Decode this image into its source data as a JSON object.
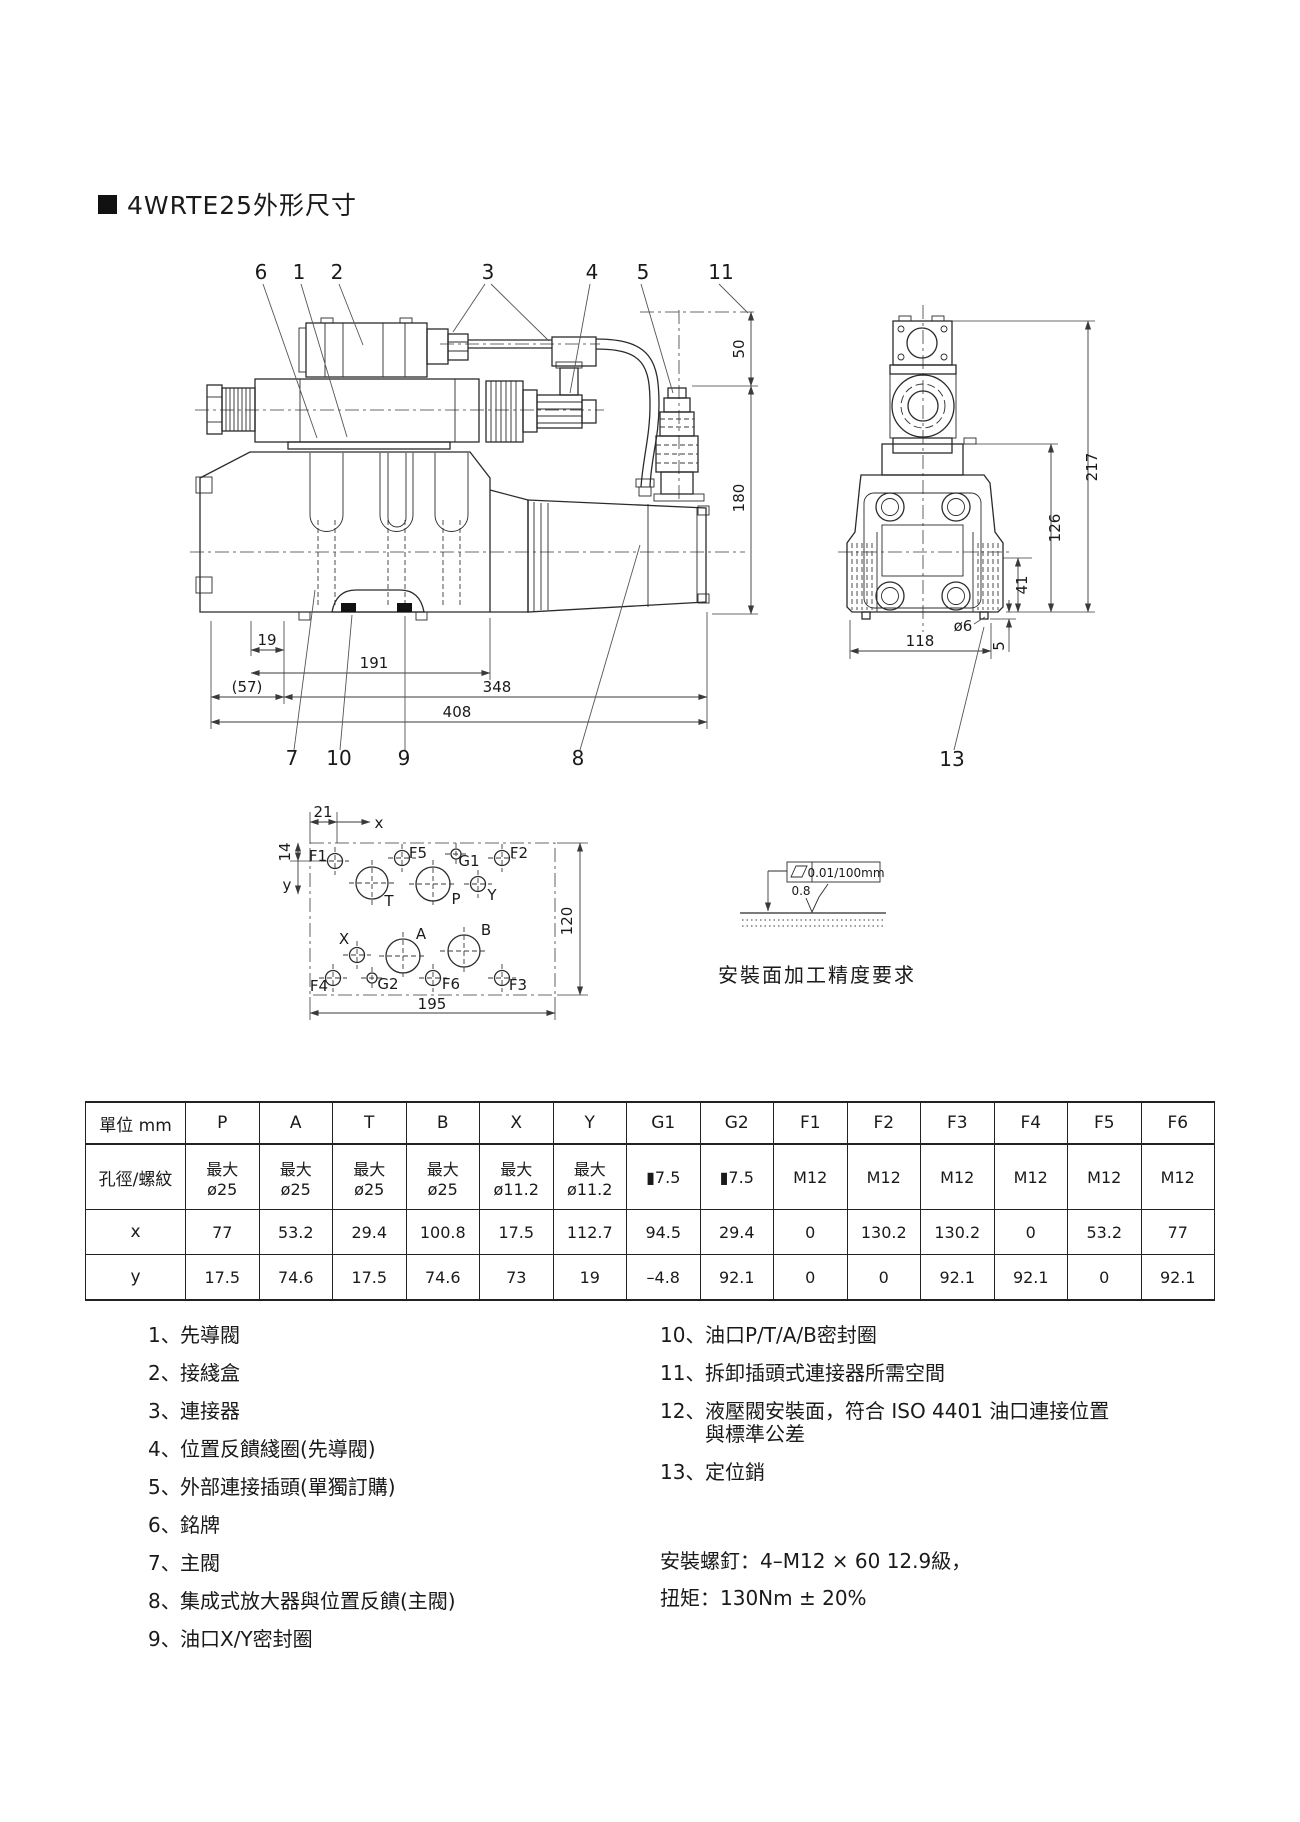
{
  "page": {
    "title": "4WRTE25外形尺寸"
  },
  "drawing": {
    "callouts": [
      "6",
      "1",
      "2",
      "3",
      "4",
      "5",
      "11",
      "7",
      "10",
      "9",
      "8",
      "13"
    ],
    "dims": {
      "d19": "19",
      "d191": "191",
      "d57": "(57)",
      "d348": "348",
      "d408": "408",
      "d50": "50",
      "d180": "180",
      "d217": "217",
      "d126": "126",
      "d41": "41",
      "d5": "5",
      "d118": "118",
      "dia6": "ø6"
    },
    "face": {
      "ports": [
        "F1",
        "F5",
        "G1",
        "F2",
        "T",
        "P",
        "Y",
        "X",
        "A",
        "B",
        "F4",
        "G2",
        "F6",
        "F3"
      ],
      "dims": {
        "d21": "21",
        "d14": "14",
        "d195": "195",
        "d120": "120"
      },
      "axis_x": "x",
      "axis_y": "y"
    },
    "finish": {
      "flatness": "0.01/100mm",
      "roughness": "0.8",
      "caption": "安裝面加工精度要求"
    }
  },
  "table": {
    "unit_header": "單位 mm",
    "spec_label": "孔徑/螺紋",
    "row_x_label": "x",
    "row_y_label": "y",
    "columns": [
      "P",
      "A",
      "T",
      "B",
      "X",
      "Y",
      "G1",
      "G2",
      "F1",
      "F2",
      "F3",
      "F4",
      "F5",
      "F6"
    ],
    "spec": [
      "最大\nø25",
      "最大\nø25",
      "最大\nø25",
      "最大\nø25",
      "最大\nø11.2",
      "最大\nø11.2",
      "▮7.5",
      "▮7.5",
      "M12",
      "M12",
      "M12",
      "M12",
      "M12",
      "M12"
    ],
    "x": [
      "77",
      "53.2",
      "29.4",
      "100.8",
      "17.5",
      "112.7",
      "94.5",
      "29.4",
      "0",
      "130.2",
      "130.2",
      "0",
      "53.2",
      "77"
    ],
    "y": [
      "17.5",
      "74.6",
      "17.5",
      "74.6",
      "73",
      "19",
      "–4.8",
      "92.1",
      "0",
      "0",
      "92.1",
      "92.1",
      "0",
      "92.1"
    ]
  },
  "legend": {
    "left": [
      {
        "num": "1、",
        "text": "先導閥"
      },
      {
        "num": "2、",
        "text": "接綫盒"
      },
      {
        "num": "3、",
        "text": "連接器"
      },
      {
        "num": "4、",
        "text": "位置反饋綫圈(先導閥)"
      },
      {
        "num": "5、",
        "text": "外部連接插頭(單獨訂購)"
      },
      {
        "num": "6、",
        "text": "銘牌"
      },
      {
        "num": "7、",
        "text": "主閥"
      },
      {
        "num": "8、",
        "text": "集成式放大器與位置反饋(主閥)"
      },
      {
        "num": "9、",
        "text": "油口X/Y密封圈"
      }
    ],
    "right": [
      {
        "num": "10、",
        "text": "油口P/T/A/B密封圈"
      },
      {
        "num": "11、",
        "text": "拆卸插頭式連接器所需空間"
      },
      {
        "num": "12、",
        "text": "液壓閥安裝面，符合 ISO 4401 油口連接位置\n與標準公差"
      },
      {
        "num": "13、",
        "text": "定位銷"
      }
    ],
    "note_line1": "安裝螺釘：4–M12 × 60 12.9級，",
    "note_line2": "扭矩：130Nm ± 20%"
  }
}
